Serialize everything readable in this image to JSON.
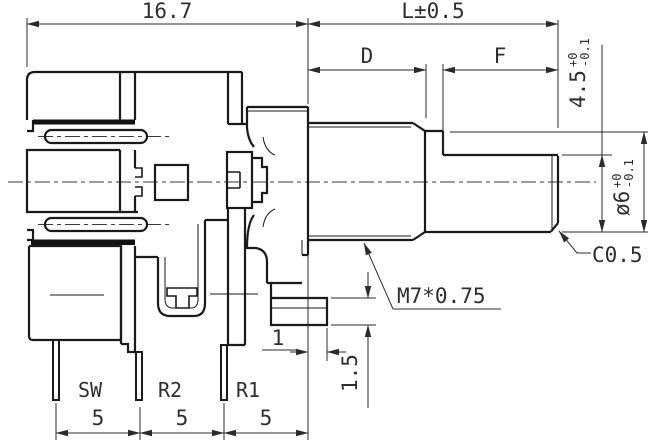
{
  "drawing": {
    "dims": {
      "body_width": "16.7",
      "shaft_length": "L±0.5",
      "bushing_length": "D",
      "flat_length": "F",
      "flat_height_main": "4.5",
      "flat_height_tol_plus": "+0",
      "flat_height_tol_minus": "-0.1",
      "shaft_dia_main": "ø6",
      "shaft_dia_tol_plus": "+0",
      "shaft_dia_tol_minus": "-0.1",
      "chamfer": "C0.5",
      "thread": "M7*0.75",
      "leg_offset": "1",
      "leg_thickness": "1.5"
    },
    "pitches": [
      "5",
      "5",
      "5"
    ],
    "pins": {
      "sw": "SW",
      "r2": "R2",
      "r1": "R1"
    }
  }
}
